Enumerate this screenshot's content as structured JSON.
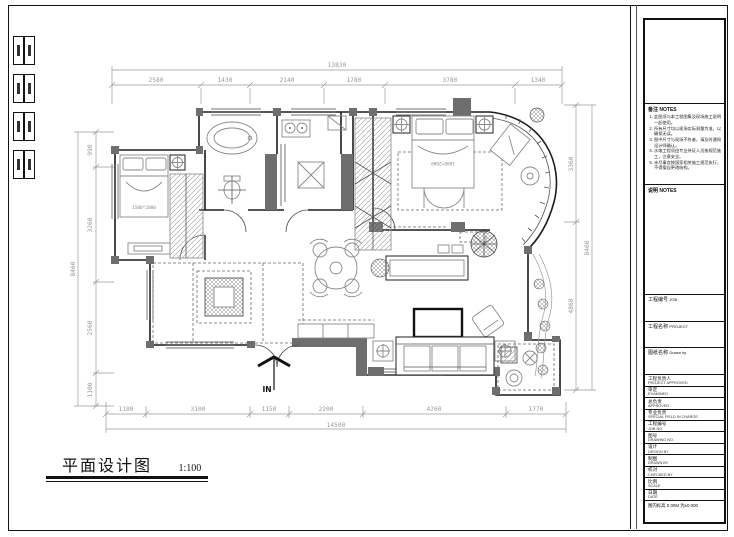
{
  "sheet": {
    "title": "平面设计图",
    "scale": "1:100",
    "entry_label": "IN"
  },
  "dims": {
    "top": {
      "total": "13830",
      "segments": [
        "2580",
        "1430",
        "2140",
        "1780",
        "3780",
        "1340"
      ]
    },
    "bottom": {
      "total": "14500",
      "segments": [
        "1180",
        "3100",
        "1150",
        "2200",
        "4260",
        "1770"
      ]
    },
    "left": {
      "total": "8460",
      "segments": [
        "990",
        "3260",
        "2560",
        "1100"
      ]
    },
    "right": {
      "total": "8460",
      "segments": [
        "3360",
        "4860"
      ]
    }
  },
  "plan": {
    "labels": {
      "bed_small": "1500*2000",
      "bed_master": "1800*2000"
    }
  },
  "notes_panel": {
    "heading": "备注 NOTES",
    "items": [
      "此图须与本工程图集及现场施工说明一起使用。",
      "所有尺寸均以现场实际测量为准，以确保无误。",
      "图中尺寸与现场不符者，请及时通知设计师确认。",
      "水电工程须由专业持证人员按规范施工，注意安全。",
      "未尽事宜按国家相关施工规范执行，不得擅自更改结构。"
    ]
  },
  "spec_panel": {
    "heading": "说明 NOTES"
  },
  "titleblock": {
    "boxes": [
      {
        "zh": "工程编号",
        "en": "JOB"
      },
      {
        "zh": "工程名称",
        "en": "PROJECT"
      },
      {
        "zh": "图纸名称",
        "en": "Drawn by"
      }
    ],
    "small_rows": [
      {
        "zh": "工程负责人",
        "en": "PROJECT APPROVED"
      },
      {
        "zh": "审定",
        "en": "EXAMINED"
      },
      {
        "zh": "总负责",
        "en": "APPROVED"
      },
      {
        "zh": "专业负责",
        "en": "SPECIAL FIELD IN CHARGE"
      },
      {
        "zh": "工程编号",
        "en": "JOB NO."
      },
      {
        "zh": "图号",
        "en": "DRAWING NO."
      },
      {
        "zh": "设计",
        "en": "DESIGN BY"
      },
      {
        "zh": "制图",
        "en": "DRAWN BY"
      },
      {
        "zh": "校对",
        "en": "CHECKED BY"
      },
      {
        "zh": "比例",
        "en": "SCALE"
      },
      {
        "zh": "日期",
        "en": "DATE"
      }
    ],
    "footer_note": "图内标高 0.00M 为±0.000"
  },
  "colors": {
    "wall_fill": "#6e6e6e",
    "line": "#1c1c1c",
    "dim_text": "#999999"
  }
}
